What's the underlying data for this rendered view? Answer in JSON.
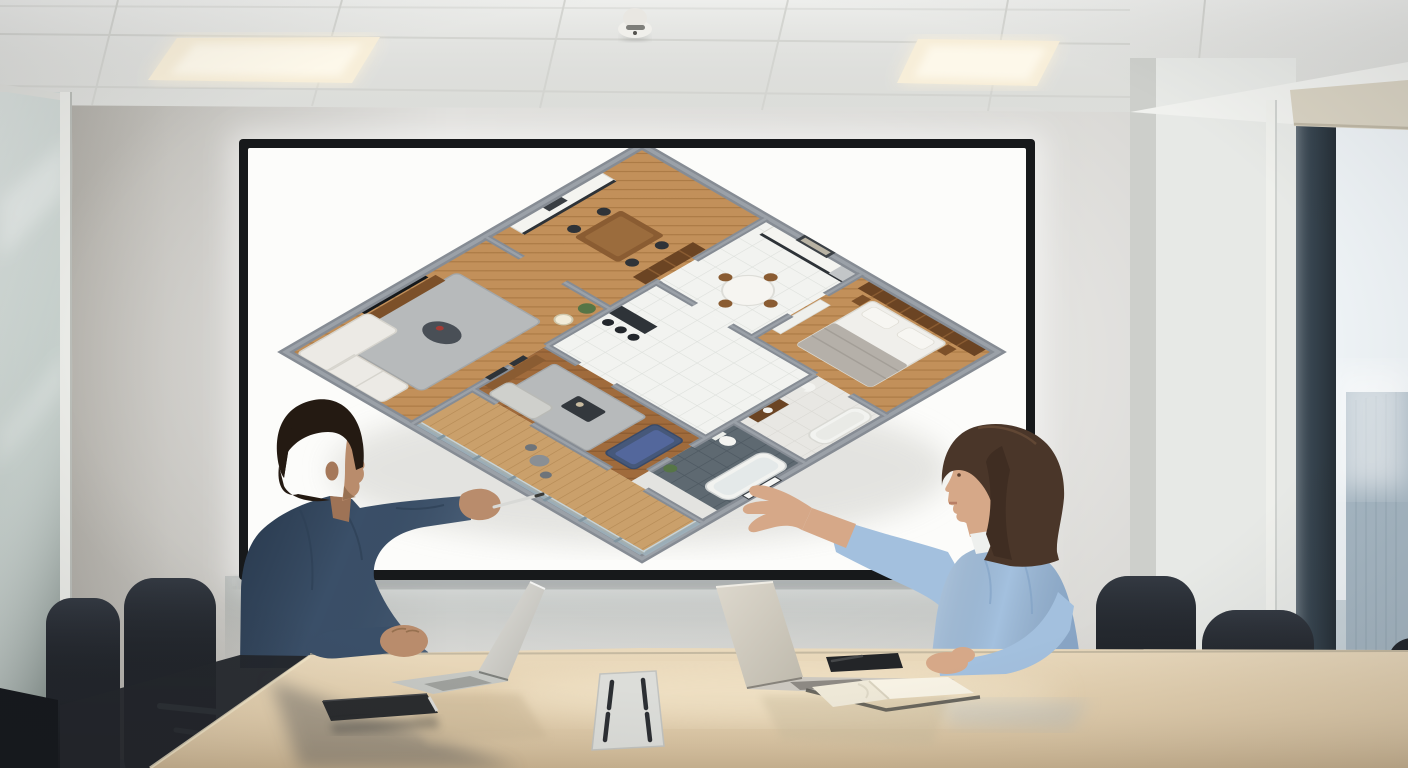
{
  "scene": {
    "setting": "conference-room",
    "text_visible": "none",
    "people": [
      {
        "id": "man",
        "position": "left",
        "hair": "short dark brown",
        "shirt": "dark blue denim shirt",
        "action": "pointing a silver pen at the floor plan on the display",
        "skin_color": "#b98c6c",
        "shirt_color": "#3a4f68",
        "hair_color": "#241a12"
      },
      {
        "id": "woman",
        "position": "right",
        "hair": "shoulder-length brown",
        "shirt": "light blue blouse",
        "action": "gesturing with open palm toward the display",
        "skin_color": "#d6a888",
        "shirt_color": "#a3c0de",
        "hair_color": "#4a3629"
      }
    ],
    "display": {
      "kind": "wall-mounted flat screen",
      "content": "isometric 3D apartment floor plan rotated 45 degrees",
      "bezel": "#17191b",
      "background": "#fcfcfa"
    },
    "floor_plan": {
      "style": "3D isometric cutaway, gray walls, rendered furniture",
      "wall_color": "#868c94",
      "wall_top_color": "#9ba1a8",
      "palette": {
        "wood": "#c2905a",
        "wood_dark": "#a06b3c",
        "tile": "#f2f3f0",
        "slate": "#5e6971",
        "marble": "#e8e7e3",
        "deck": "#caa06b",
        "rug": "#b7babb",
        "sofa_white": "#eceae5",
        "sofa_blue": "#46587a",
        "sofa_gray": "#cfd0cc",
        "bookshelf": "#6b4423",
        "bed": "#f0efeb",
        "duvet": "#b5b0a9",
        "cabinet": "#f4f4f0",
        "counter": "#2d3237",
        "tub": "#f2f3f0",
        "plant": "#567546",
        "tv": "#15181b",
        "railing": "#9fb3bd"
      },
      "rooms": [
        {
          "name": "kitchen-dining",
          "floor": "wood",
          "furniture": [
            "white cabinets",
            "dark countertop",
            "dining table",
            "four chairs",
            "bookshelf"
          ]
        },
        {
          "name": "living-room-1",
          "floor": "wood herringbone",
          "furniture": [
            "wall TV",
            "media console",
            "gray rug",
            "white sofa",
            "floor lamp",
            "plant",
            "coffee table"
          ]
        },
        {
          "name": "kitchen-2",
          "floor": "white tile",
          "furniture": [
            "white cabinets",
            "fridge",
            "round dining table",
            "bar with stools"
          ]
        },
        {
          "name": "bedroom",
          "floor": "wood",
          "furniture": [
            "full-wall bookshelf headboard",
            "double bed",
            "gray duvet",
            "pillows",
            "nightstands",
            "wardrobe"
          ]
        },
        {
          "name": "bathroom-light",
          "floor": "light tile",
          "furniture": [
            "bathtub",
            "vanity",
            "toilet"
          ]
        },
        {
          "name": "bathroom-dark",
          "floor": "dark slate tile",
          "furniture": [
            "bathtub",
            "toilet",
            "window",
            "plant"
          ]
        },
        {
          "name": "living-room-2",
          "floor": "dark wood",
          "furniture": [
            "sideboard",
            "wall frames",
            "blue sofa",
            "gray sofa",
            "rug",
            "coffee table"
          ]
        },
        {
          "name": "balcony",
          "floor": "wood deck",
          "furniture": [
            "glass railing",
            "outdoor table"
          ]
        }
      ]
    },
    "table": {
      "kind": "conference table",
      "color": "#e0cba9",
      "items": [
        "open laptop (left)",
        "open laptop (right)",
        "black closed notebook",
        "open notebook",
        "phone with pen on top",
        "cable grommet panel"
      ]
    },
    "chairs": {
      "count": 5,
      "color": "#23272d",
      "accent": "chrome armrests"
    },
    "ceiling": {
      "type": "suspended tile grid",
      "light_panels": 2,
      "light_color": "#f7eed9",
      "smoke_detector": true
    },
    "window": {
      "position": "right",
      "view": "city high-rise buildings",
      "mullion_color": "#3c4b57",
      "blind_color": "#d9d3c3"
    },
    "glass_partition": {
      "position": "left",
      "tint": "#c3cdc9"
    },
    "colors": {
      "wall": "#d6d5d1",
      "ceiling": "#e8e9e6",
      "table": "#e0cba9",
      "sky": "#edf2f5",
      "building": "#a5b6c2",
      "chair": "#23272d"
    }
  }
}
